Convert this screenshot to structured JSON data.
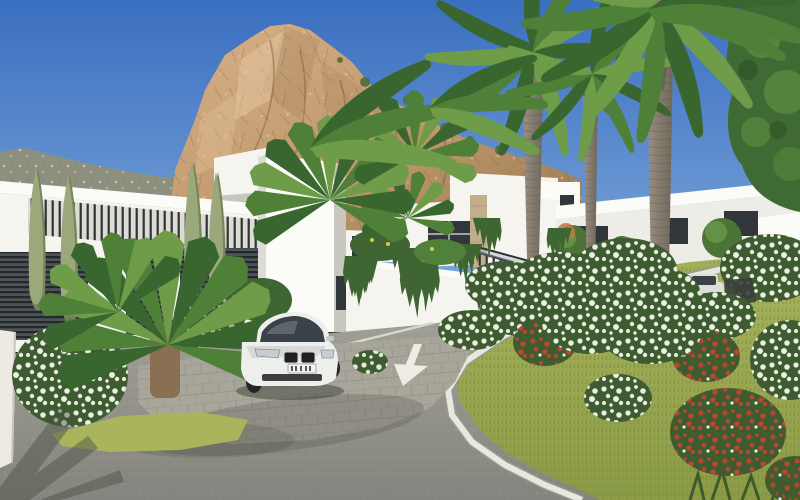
{
  "scene": {
    "description": "3D architectural rendering of a hillside residential development: white modern villas among tall palm trees and white and red flowering shrubs along a curving asphalt road beneath a rocky mountain peak under a blue sky, with a white sports car parked on a cobbled driveway and two more cars up the lane",
    "road_marking": {
      "type": "arrow",
      "direction": "down"
    }
  },
  "palette": {
    "sky_top": "#3a6fc0",
    "sky_horizon": "#82abdc",
    "hill": "#8d907e",
    "hill_speck": "#d8d6c8",
    "mtn_light": "#d8b089",
    "mtn_mid": "#bf986c",
    "mtn_dark": "#97764f",
    "mtn_crevice": "#7d5f41",
    "mtn_glow": "#e8cda6",
    "shrub_green": "#4d6b33",
    "bldg_white": "#f5f4ef",
    "bldg_bright": "#fbfbf8",
    "bldg_shade": "#dcdbd4",
    "bldg_dim": "#c7c6bf",
    "win_dark": "#31363a",
    "louver_bg": "#4d5356",
    "louver_dark": "#23282b",
    "railing_dark": "#2e3336",
    "stone": "#c3ae8c",
    "glass": "#9db3c1",
    "vine": "#3f6532",
    "palm_dark": "#39662f",
    "palm_mid": "#4f8038",
    "palm_light": "#6f9c49",
    "trunk": "#9b9184",
    "trunk_dark": "#6e6659",
    "ring": "#5e574c",
    "cypress": "#9aa87c",
    "cypress_dark": "#76865a",
    "grass": "#8b9b46",
    "grass_light": "#a9b45c",
    "grass_dark": "#6d7f35",
    "hedge_green": "#567741",
    "hedge_dark": "#3e5c30",
    "flower_white": "#f3f5ec",
    "flower_red": "#c0452f",
    "road_near": "#85857f",
    "road_far": "#a7a69b",
    "asphalt_dot_d": "#6f6f68",
    "asphalt_dot_l": "#b9b8ae",
    "cobble": "#a8a59a",
    "cobble_line": "#908d82",
    "curb": "#e9e8de",
    "curb_shade": "#9a998f",
    "car_white": "#edefec",
    "car_shade": "#c6c9c6",
    "car_glass": "#3a4148",
    "car_dark": "#1e2022",
    "tire": "#26262a",
    "car2": "#dcdeda",
    "shadow": "#3c4238",
    "arrow": "#eeede3",
    "orange_bush": "#c07a40"
  }
}
